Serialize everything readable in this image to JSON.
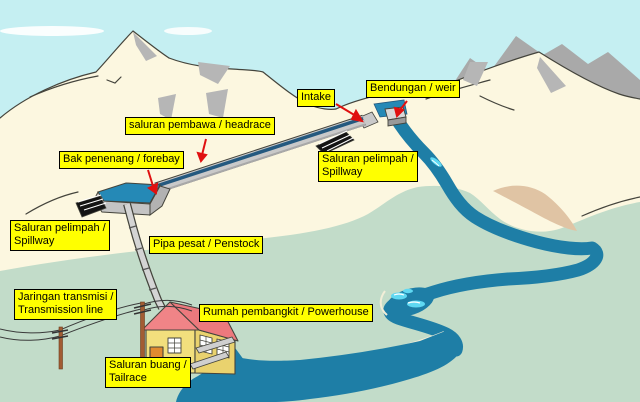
{
  "diagram": {
    "description": "Micro-hydro power scheme illustration with Indonesian / English labels",
    "labels": [
      {
        "id": "intake",
        "lines": [
          "Intake"
        ]
      },
      {
        "id": "weir",
        "lines": [
          "Bendungan / weir"
        ]
      },
      {
        "id": "headrace",
        "lines": [
          "saluran pembawa / headrace"
        ]
      },
      {
        "id": "forebay",
        "lines": [
          "Bak penenang / forebay"
        ]
      },
      {
        "id": "spillway-upper",
        "lines": [
          "Saluran pelimpah /",
          "Spillway"
        ]
      },
      {
        "id": "spillway-lower",
        "lines": [
          "Saluran pelimpah /",
          "Spillway"
        ]
      },
      {
        "id": "penstock",
        "lines": [
          "Pipa pesat / Penstock"
        ]
      },
      {
        "id": "transmission",
        "lines": [
          "Jaringan transmisi /",
          "Transmission line"
        ]
      },
      {
        "id": "powerhouse",
        "lines": [
          "Rumah pembangkit / Powerhouse"
        ]
      },
      {
        "id": "tailrace",
        "lines": [
          "Saluran buang /",
          "Tailrace"
        ]
      }
    ],
    "colors": {
      "sky": "#C5EFF2",
      "cloud": "#FFFFFF",
      "mountain": "#FCF7E0",
      "mountain_back": "#A9A9A9",
      "mountain_shadow": "#B6B6B6",
      "outline": "#44443C",
      "lowland_green": "#C2DCC9",
      "sand_bank": "#E0C4A4",
      "river": "#1E7EA6",
      "forebay_water": "#2589B6",
      "channel_water": "#24597F",
      "rapids": "#5FD8F2",
      "label_bg": "#FFFF00",
      "label_border": "#000000",
      "arrow": "#E01010",
      "structure_gray": "#C9C9C9",
      "house_wall": "#F2DF7D",
      "house_roof": "#F08487",
      "house_door": "#E08A30",
      "pole": "#A25C33"
    }
  }
}
